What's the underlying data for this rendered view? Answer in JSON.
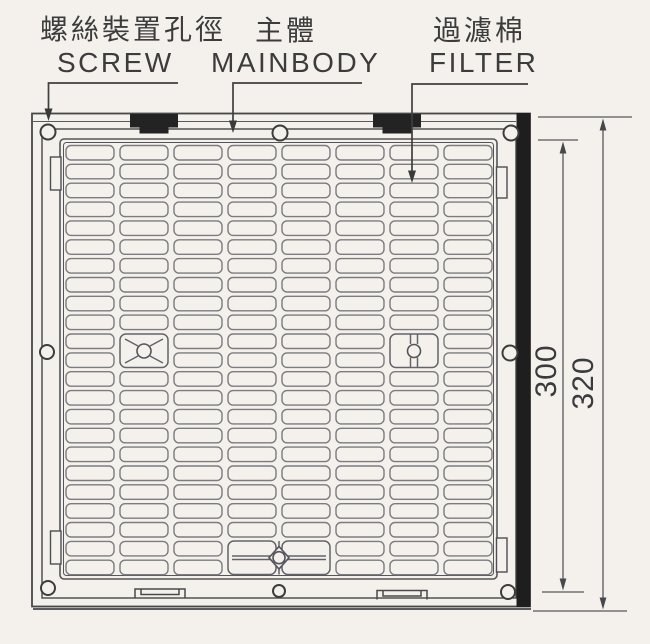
{
  "labels": {
    "screw_zh": "螺絲裝置孔徑",
    "screw_en": "SCREW",
    "mainbody_zh": "主體",
    "mainbody_en": "MAINBODY",
    "filter_zh": "過濾棉",
    "filter_en": "FILTER"
  },
  "dimensions": {
    "filter_height": "300",
    "body_height": "320"
  },
  "colors": {
    "background": "#f4f1ec",
    "line": "#474747",
    "slot_line": "#7b7b80",
    "dark_fill": "#1e1e1e",
    "text": "#3c3c3c"
  },
  "grid": {
    "cols": 8,
    "rows": 23,
    "x0": 66,
    "y0": 145.5,
    "pitch_x": 54,
    "pitch_y": 18.85,
    "slot_w": 48,
    "slot_h": 14.5,
    "corner_radius": 5,
    "skip_cells": [
      [
        1,
        10
      ],
      [
        1,
        11
      ],
      [
        6,
        10
      ],
      [
        6,
        11
      ],
      [
        3,
        21
      ],
      [
        3,
        22
      ],
      [
        4,
        21
      ],
      [
        4,
        22
      ]
    ]
  }
}
